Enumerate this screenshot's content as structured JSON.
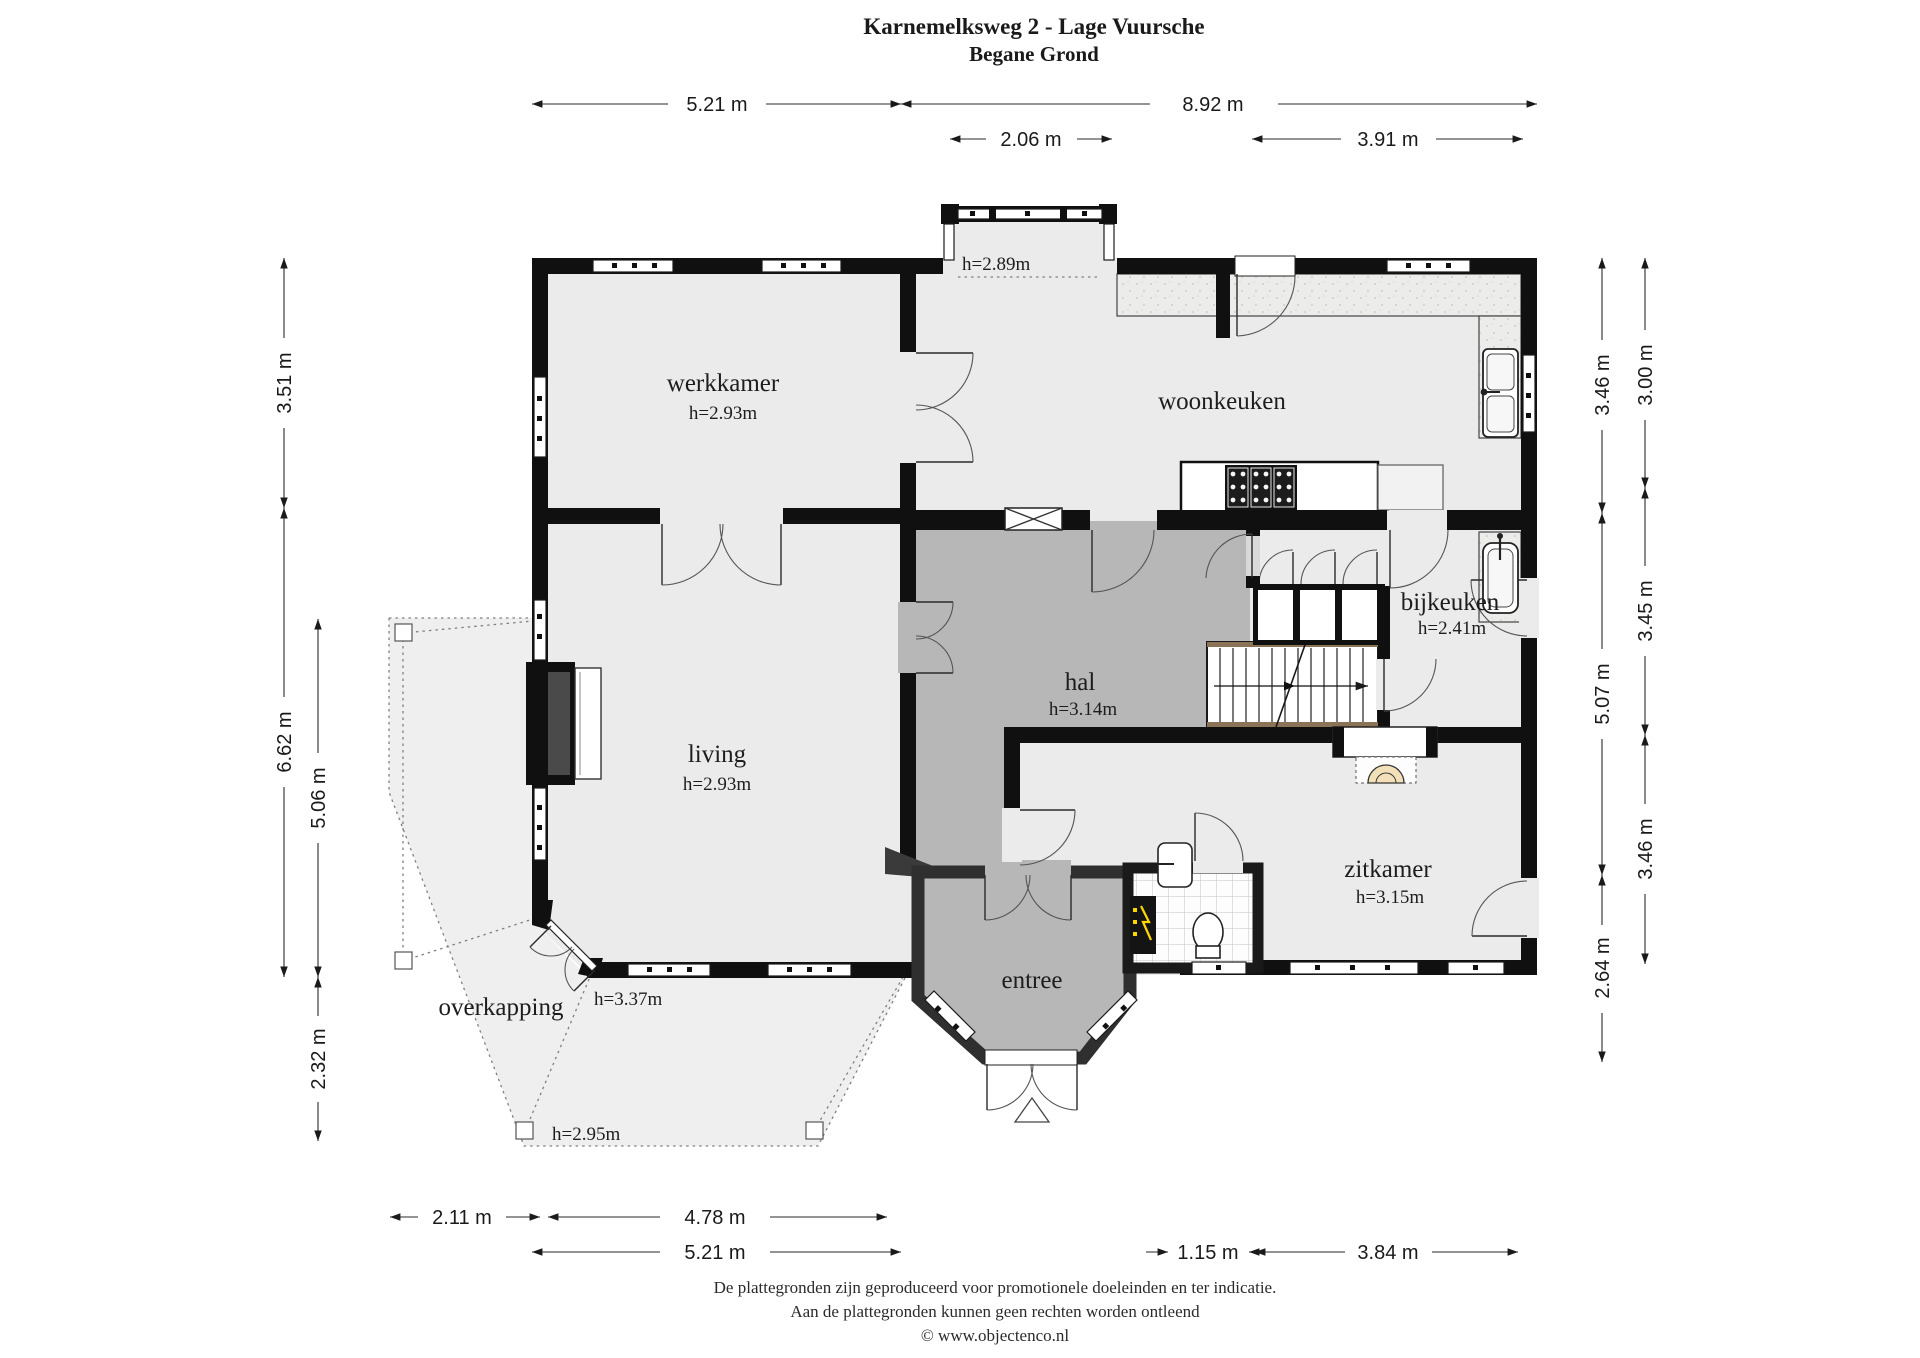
{
  "title": "Karnemelksweg 2 - Lage Vuursche",
  "subtitle": "Begane Grond",
  "rooms": {
    "werkkamer": {
      "name": "werkkamer",
      "height": "h=2.93m"
    },
    "woonkeuken": {
      "name": "woonkeuken"
    },
    "hal": {
      "name": "hal",
      "height": "h=3.14m"
    },
    "bijkeuken": {
      "name": "bijkeuken",
      "height": "h=2.41m"
    },
    "living": {
      "name": "living",
      "height": "h=2.93m"
    },
    "zitkamer": {
      "name": "zitkamer",
      "height": "h=3.15m"
    },
    "entree": {
      "name": "entree"
    },
    "overkapping": {
      "name": "overkapping"
    }
  },
  "heights": {
    "bay": "h=2.89m",
    "terrace_door": "h=3.37m",
    "overkapping_low": "h=2.95m"
  },
  "dims": {
    "top_row1": [
      "5.21 m",
      "8.92 m"
    ],
    "top_row2": [
      "2.06 m",
      "3.91 m"
    ],
    "left_outer": [
      "3.51 m",
      "6.62 m"
    ],
    "left_inner": [
      "5.06 m",
      "2.32 m"
    ],
    "right_inner": [
      "3.46 m",
      "5.07 m",
      "2.64 m"
    ],
    "right_outer": [
      "3.00 m",
      "3.45 m",
      "3.46 m"
    ],
    "bottom_row1": [
      "2.11 m",
      "4.78 m"
    ],
    "bottom_row2": [
      "5.21 m",
      "1.15 m",
      "3.84 m"
    ]
  },
  "footer": [
    "De plattegronden zijn geproduceerd voor promotionele doeleinden en ter indicatie.",
    "Aan de plattegronden kunnen geen rechten worden ontleend",
    "© www.objectenco.nl"
  ],
  "colors": {
    "wall": "#101010",
    "floor": "#ebebeb",
    "hall_floor": "#b7b7b7",
    "wood": "#8a7356",
    "stove_glow": "#f3e0b8",
    "meter_bolt": "#ffd700"
  }
}
